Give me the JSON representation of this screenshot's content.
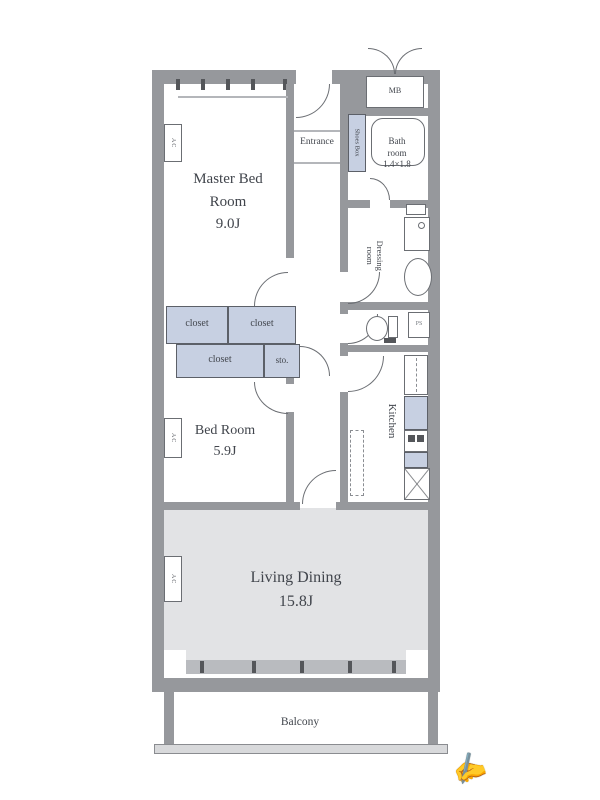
{
  "rooms": {
    "master_bedroom": {
      "label": "Master Bed Room",
      "area": "9.0J"
    },
    "bedroom": {
      "label": "Bed Room",
      "area": "5.9J"
    },
    "living_dining": {
      "label": "Living Dining",
      "area": "15.8J"
    },
    "kitchen": {
      "label": "Kitchen"
    },
    "entrance": {
      "label": "Entrance"
    },
    "bathroom": {
      "line1": "Bath",
      "line2": "room",
      "dims": "1.4×1.8"
    },
    "dressing_room": {
      "label": "Dressing room"
    },
    "balcony": {
      "label": "Balcony"
    }
  },
  "storage": {
    "closet_a": "closet",
    "closet_b": "closet",
    "closet_c": "closet",
    "sto": "sto.",
    "shoes_box": "Shoes Box"
  },
  "fixtures": {
    "meter_box": "MB",
    "pipe_space": "PS",
    "air_conditioner": "AC"
  },
  "icons": {
    "cursor": "✍"
  },
  "colors": {
    "wall": "#96989c",
    "wall_dark": "#54565a",
    "storage_blue": "#c7d0e2",
    "living_gray": "#e2e3e5",
    "line": "#6b6e73",
    "text": "#41454c"
  }
}
